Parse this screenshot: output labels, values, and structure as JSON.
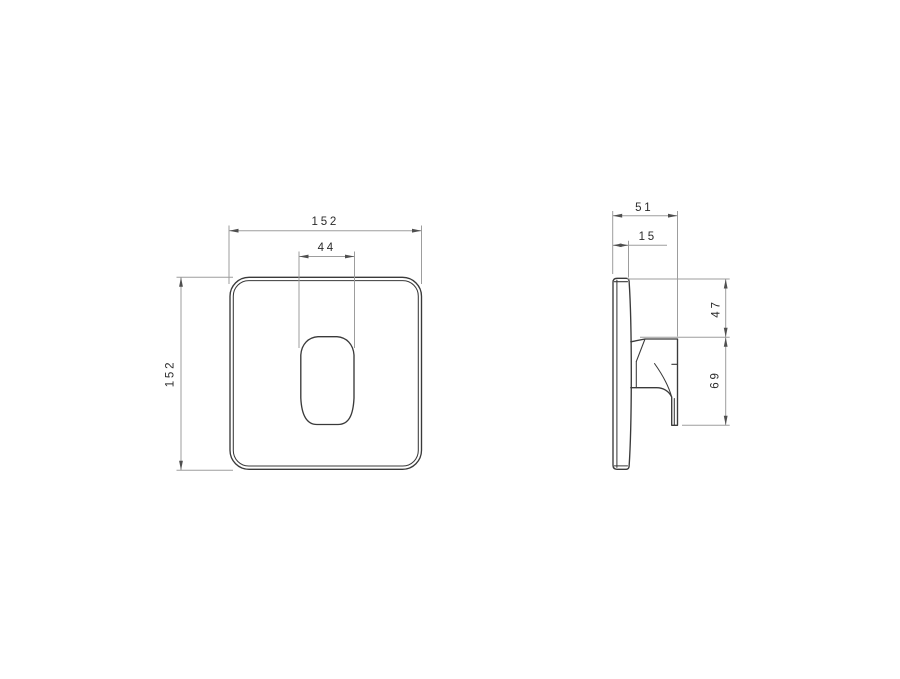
{
  "drawing": {
    "background": "#ffffff",
    "front_view": {
      "width_label": "152",
      "height_label": "152",
      "button_width_label": "44"
    },
    "side_view": {
      "overall_depth_label": "51",
      "plate_depth_label": "15",
      "upper_offset_label": "47",
      "handle_span_label": "69"
    },
    "colors": {
      "outline": "#3a3a3a",
      "dimension_line": "#9d9d9d",
      "arrowhead": "#4f4f4f",
      "text": "#2b2b2b"
    }
  }
}
